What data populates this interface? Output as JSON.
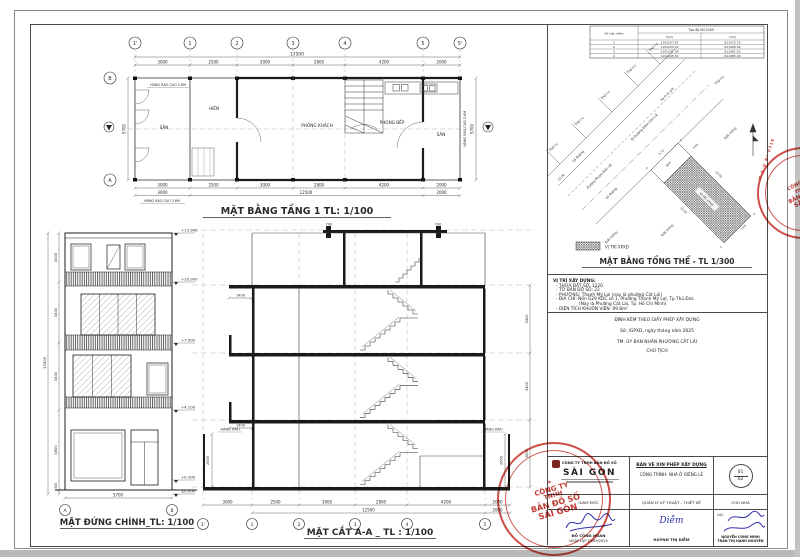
{
  "colors": {
    "paper": "#ffffff",
    "line": "#2b2b2b",
    "stamp_red": "#c23a33",
    "signature_blue": "#2f2fae"
  },
  "floor_plan": {
    "title": "MẶT BẰNG TẦNG 1 TL: 1/100",
    "grid_cols": [
      "1'",
      "1",
      "2",
      "3",
      "4",
      "5",
      "5'"
    ],
    "grid_rows": [
      "B",
      "A"
    ],
    "dim_total_top": "17500",
    "dims_top": [
      "3000",
      "2500",
      "3000",
      "2800",
      "4200",
      "2000"
    ],
    "dims_bottom": [
      "3000",
      "2500",
      "3000",
      "2800",
      "4200",
      "2000"
    ],
    "dims_bottom2": [
      "3000",
      "12500",
      "2000"
    ],
    "dim_side_left": "5700",
    "dim_side_right": "5700",
    "fence_label": "HÀNG RÀO CAO 2.6M",
    "rooms": {
      "san_left": "SÂN",
      "hien": "HIÊN",
      "khach": "PHÒNG KHÁCH",
      "bep": "PHÒNG BẾP",
      "san_right": "SÂN"
    }
  },
  "elevation": {
    "title": "MẶT ĐỨNG CHÍNH_TL: 1/100",
    "levels": [
      "+13.900",
      "+10.900",
      "+7.500",
      "+4.100",
      "+0.300",
      "±0.000"
    ],
    "dims_left": [
      "3000",
      "3400",
      "3400",
      "3800",
      "300"
    ],
    "dim_total": "13900",
    "dim_bottom": "5700",
    "grid": [
      "A",
      "B"
    ]
  },
  "section": {
    "title": "MẶT CẮT A-A _ TL : 1/100",
    "grid": [
      "1'",
      "1",
      "2",
      "3",
      "4",
      "5"
    ],
    "dims_bottom": [
      "3000",
      "2500",
      "3000",
      "2800",
      "4200",
      "2000"
    ],
    "dim_total": "12500",
    "dim_right_extra": "2000",
    "dims_right": [
      "3400",
      "3400",
      "3800"
    ],
    "dims_side": [
      "2600",
      "2600"
    ],
    "balcony_dims": [
      "1400",
      "1400"
    ],
    "parapet_dims": [
      "700",
      "700"
    ],
    "fence_label": "HÀNG RÀO"
  },
  "site": {
    "title": "MẶT BẰNG TỔNG THỂ - TL 1/300",
    "legend_label": "VỊ TRÍ XPXD",
    "table": {
      "corner_header": "Số hiệu điểm",
      "main_header": "Tọa độ VN 2000",
      "col_x": "X(m)",
      "col_y": "Y(m)",
      "rows": [
        {
          "id": "1",
          "x": "1191257.67",
          "y": "611072.75"
        },
        {
          "id": "2",
          "x": "1191253.43",
          "y": "611068.82"
        },
        {
          "id": "3",
          "x": "1191241.39",
          "y": "611081.52"
        },
        {
          "id": "4",
          "x": "1191245.52",
          "y": "611085.44"
        }
      ]
    },
    "labels": {
      "tho_cu": "Thổ cư",
      "le_duong": "Lề đường",
      "street1": "Đường Phạm Đôn Lễ",
      "street2": "Đi Đường Đàm Văn Lễ",
      "ranh": "Ranh lộ giới",
      "dat_trong": "Đất trống",
      "san": "Sân",
      "parcel": "VỊ TRÍ XPXD"
    },
    "dims": {
      "front": "5.70",
      "san_side": "3.05",
      "side_a": "12.50",
      "side_b": "12.50",
      "rear": "3.05",
      "street": "13.00"
    },
    "corners": [
      "1",
      "2",
      "3",
      "4"
    ]
  },
  "info": {
    "heading": "VỊ TRÍ XÂY DỰNG:",
    "lines": [
      "- THỬA ĐẤT SỐ: 1220",
      "- TỜ BẢN ĐỒ SỐ:  22",
      "- PHƯỜNG: Thạnh Mỹ Lợi (nay là phường Cát Lái)",
      "- ĐỊA CHỈ:   Nền G29 KDC số 1, Phường Thạnh Mỹ Lợi, Tp.Thủ Đức",
      "(Nay là Phường Cát Lái, Tp. Hồ Chí Minh)",
      "- DIỆN TÍCH KHUÔN VIÊN:  99.8m²"
    ]
  },
  "permit": {
    "line1": "ĐÍNH KÈM THEO GIẤY PHÉP XÂY DỰNG",
    "line2": "Số:          /GPXD, ngày          tháng          năm 2025",
    "line3": "TM. ỦY BAN NHÂN PHƯỜNG CÁT LÁI",
    "line4": "CHỦ TỊCH"
  },
  "titleblock": {
    "company_line1": "CÔNG TY TNHH BẢN ĐỒ SỐ",
    "company_line2": "SÀI GÒN",
    "doc_type": "BẢN VẼ XIN PHÉP XÂY DỰNG",
    "project": "CÔNG TRÌNH: NHÀ Ở RIÊNG LẺ",
    "sheet_no": "01",
    "sheet_total": "02",
    "role_director": "GIÁM ĐỐC",
    "role_tech": "QUẢN LÝ KỸ THUẬT - THIẾT KẾ",
    "role_owner": "CHỦ NHÀ",
    "sig_director_name": "ĐỖ CÔNG HOAN",
    "sig_date": "NGÀY LẬP 22/09/2025",
    "sig_tech_hand": "Diễm",
    "sig_tech_name": "HUỲNH THỊ DIỄM",
    "uq": "UQ.",
    "owner_name1": "NGUYỄN CÔNG MINH",
    "owner_name2": "TRẦN THỊ HẠNH NGUYÊN"
  },
  "stamps": {
    "line1": "CÔNG TY",
    "line2": "TNHH",
    "line3": "BẢN ĐỒ SỐ",
    "line4": "SÀI GÒN",
    "ring_text": "M.S.D N° 0318",
    "star": "★"
  }
}
